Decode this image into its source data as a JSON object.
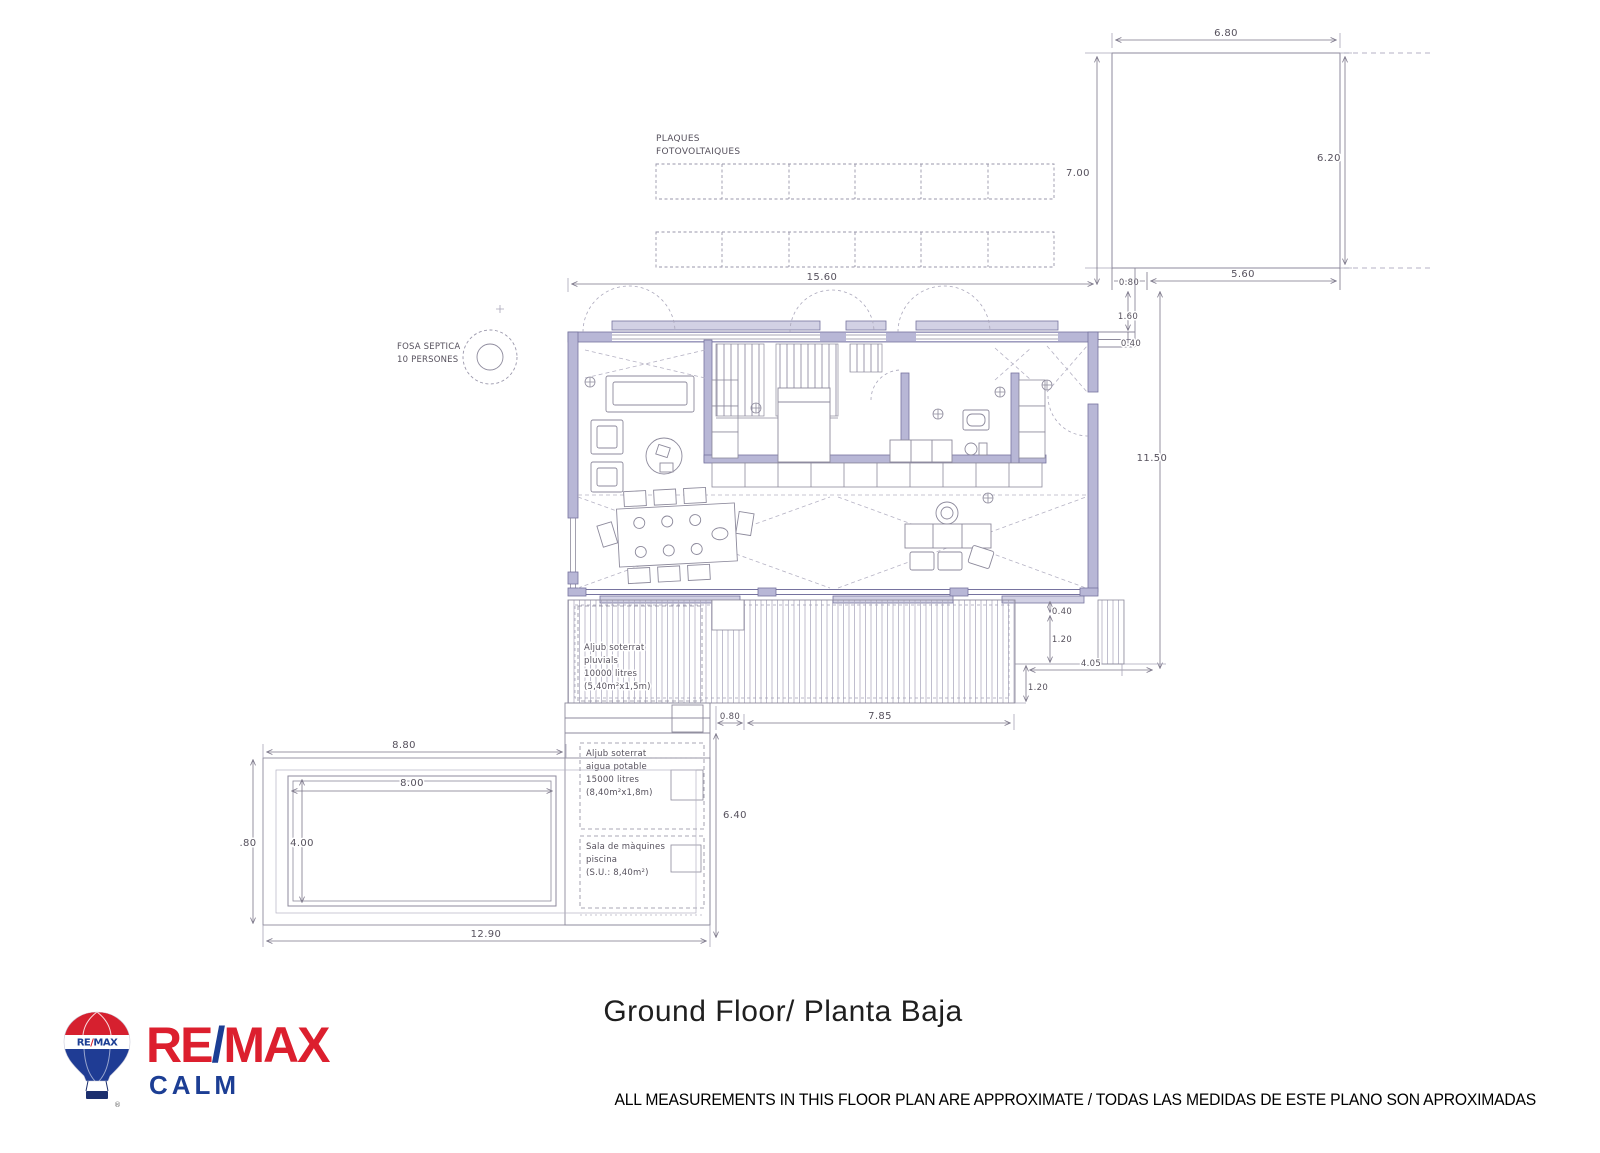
{
  "page": {
    "title": "Ground Floor/ Planta Baja",
    "disclaimer": "ALL MEASUREMENTS IN THIS FLOOR PLAN ARE APPROXIMATE / TODAS LAS MEDIDAS DE ESTE PLANO SON APROXIMADAS"
  },
  "logo": {
    "re": "RE",
    "slash": "/",
    "max": "MAX",
    "office": "CALM",
    "reg": "®",
    "balloon": {
      "re": "RE",
      "slash": "/",
      "max": "MAX"
    },
    "colors": {
      "red": "#DC1F2E",
      "blue": "#1C3E94"
    }
  },
  "annotations": {
    "solar": {
      "l1": "PLAQUES",
      "l2": "FOTOVOLTAIQUES"
    },
    "fosa": {
      "l1": "FOSA SEPTICA",
      "l2": "10 PERSONES"
    },
    "aljub_pluvial": {
      "l1": "Aljub soterrat",
      "l2": "pluvials",
      "l3": "10000 litres",
      "l4": "(5,40m²x1,5m)"
    },
    "aljub_potable": {
      "l1": "Aljub soterrat",
      "l2": "aigua potable",
      "l3": "15000 litres",
      "l4": "(8,40m²x1,8m)"
    },
    "sala": {
      "l1": "Sala de màquines",
      "l2": "piscina",
      "l3": "(S.U.: 8,40m²)"
    }
  },
  "dims": {
    "garage_top": "6.80",
    "garage_right": "6.20",
    "garage_left": "7.00",
    "garage_bottom": "5.60",
    "link_width": "0.80",
    "link_h1": "1.60",
    "link_h2": "0.40",
    "house_width": "15.60",
    "site_depth": "11.50",
    "stepA": "0.40",
    "stepB": "1.20",
    "stepC": "4.05",
    "stepD": "1.20",
    "deck_offset": "0.80",
    "deck_width": "7.85",
    "equip_depth": "6.40",
    "pool_zone": "8.80",
    "pool_len": "8.00",
    "pool_wid": "4.00",
    "pool_edge": ".80",
    "zone_width": "12.90"
  }
}
